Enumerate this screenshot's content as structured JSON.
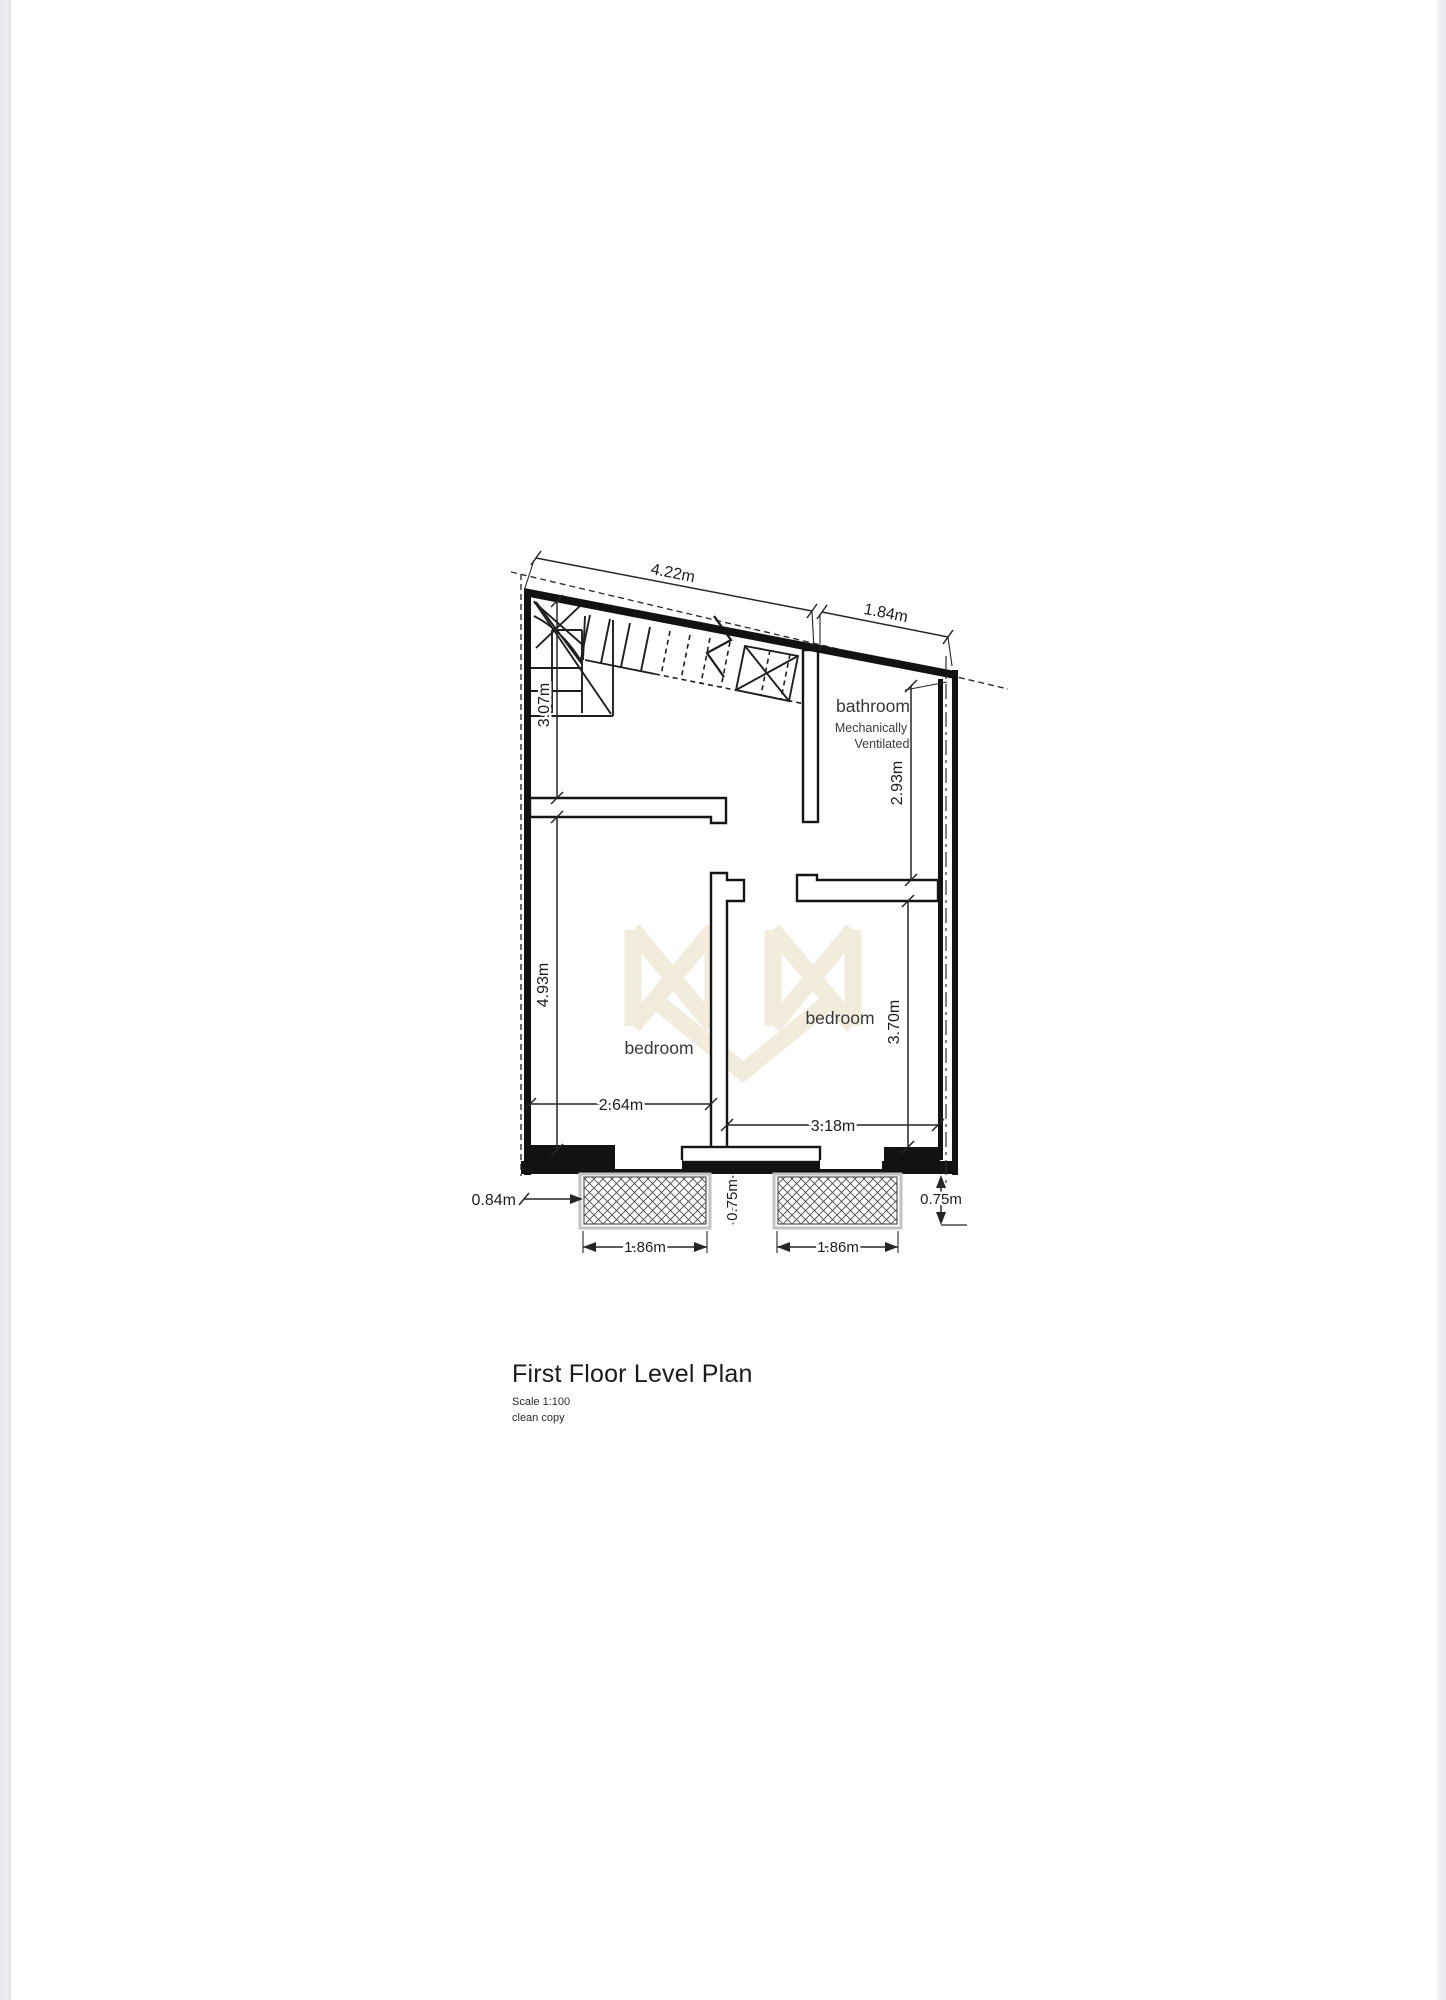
{
  "plan": {
    "title": "First Floor Level Plan",
    "scale_note": "Scale 1:100",
    "revision_note": "clean copy",
    "labels": {
      "bathroom": "bathroom",
      "bathroom_note1": "Mechanically",
      "bathroom_note2": "Ventilated",
      "bedroom_left": "bedroom",
      "bedroom_right": "bedroom"
    },
    "dimensions": {
      "top_width": "4.22m",
      "top_right_width": "1.84m",
      "stair_depth": "3.07m",
      "bathroom_depth": "2.93m",
      "bedroom_left_depth": "4.93m",
      "bedroom_right_depth": "3.70m",
      "bedroom_left_width": "2.64m",
      "bedroom_right_width": "3.18m",
      "side_offset": "0.84m",
      "balcony_depth_mid": "0.75m",
      "balcony_depth_right": "0.75m",
      "balcony_left_width": "1.86m",
      "balcony_right_width": "1.86m"
    },
    "colors": {
      "ink": "#1c1c1c",
      "dimension_ink": "#262626",
      "label_ink": "#3a3a3a",
      "watermark": "#f1ecdb",
      "balcony_edge": "#8f8f8f",
      "page_edge_strip": "#e9e9ef"
    }
  }
}
